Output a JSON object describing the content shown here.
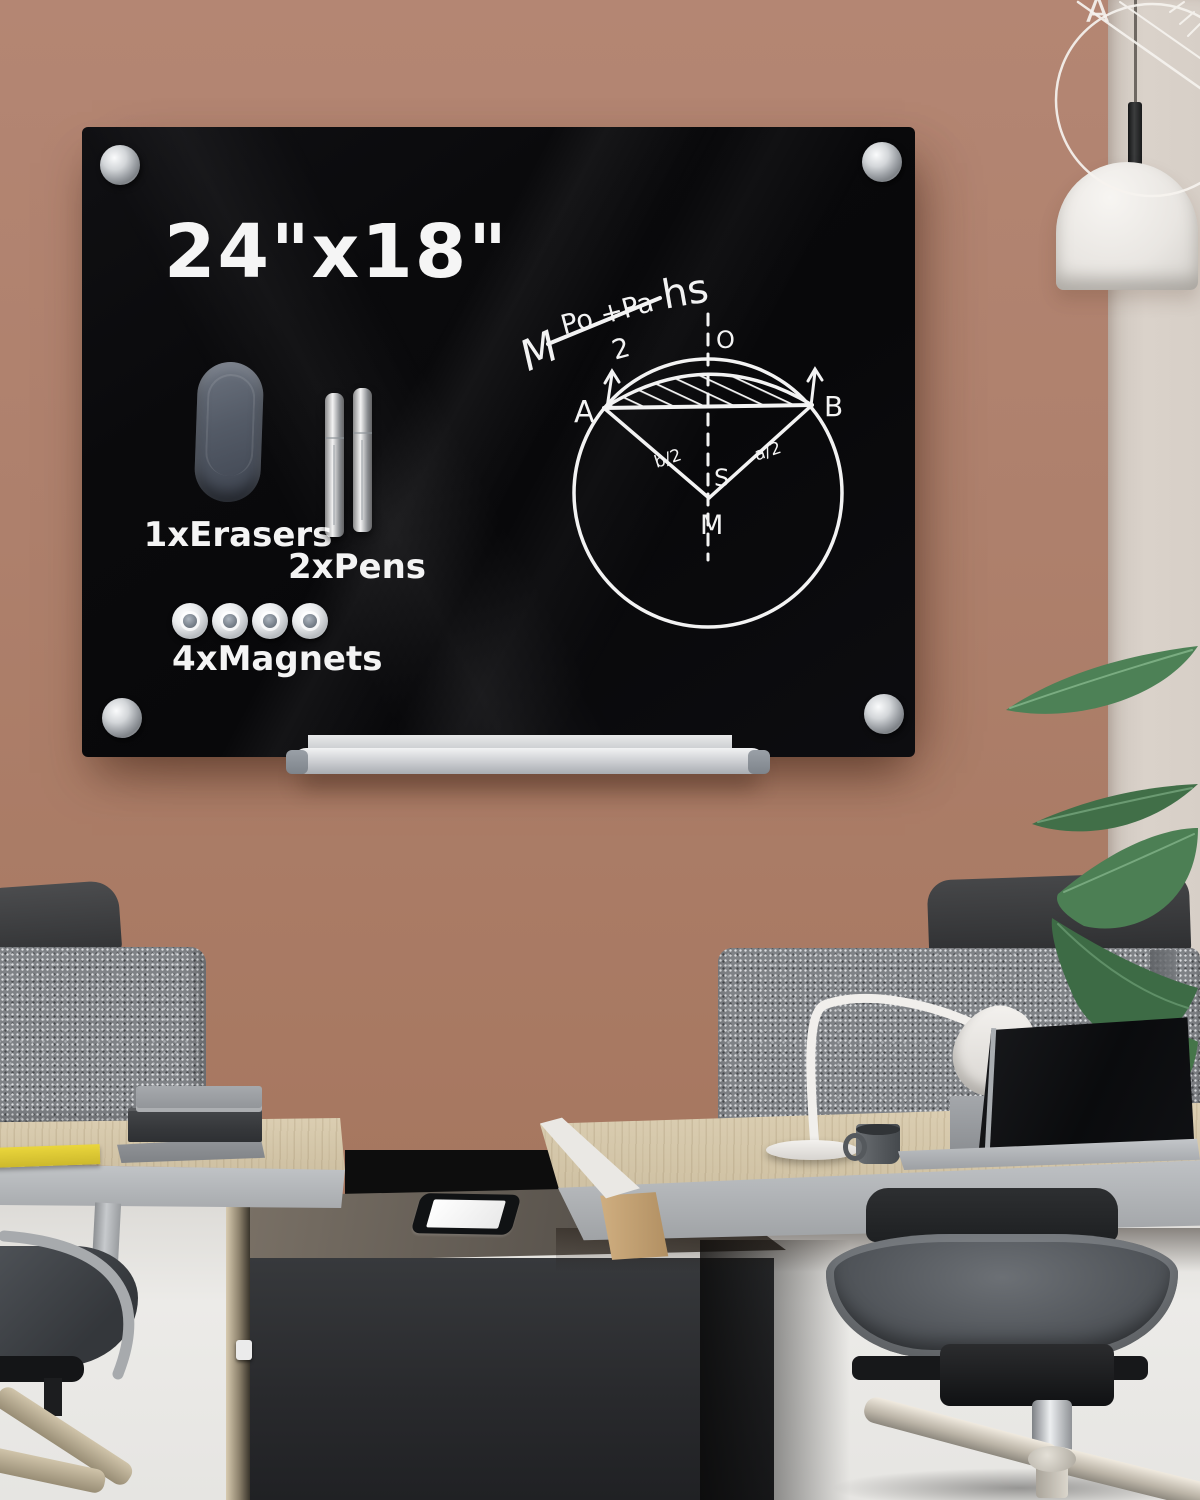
{
  "scene": {
    "wall_color": "#ab7e6a",
    "panel_color": "#d8d0c9",
    "floor_color": "#e9e8e5",
    "board_color": "#0b0b0d",
    "accent_silver": "#c7cacd",
    "plant_green": "#47784f"
  },
  "board": {
    "size_label": "24\"x18\"",
    "eraser_label": "1xErasers",
    "pens_label": "2xPens",
    "magnets_label": "4xMagnets"
  },
  "diagram": {
    "formula_prefix": "M",
    "formula_numerator": "Po +Pa",
    "formula_denominator": "2",
    "formula_suffix": "hs",
    "point_a": "A",
    "point_b": "B",
    "point_o": "O",
    "point_s": "S",
    "point_m": "M",
    "fraction_left": "b/2",
    "fraction_right": "a/2"
  }
}
